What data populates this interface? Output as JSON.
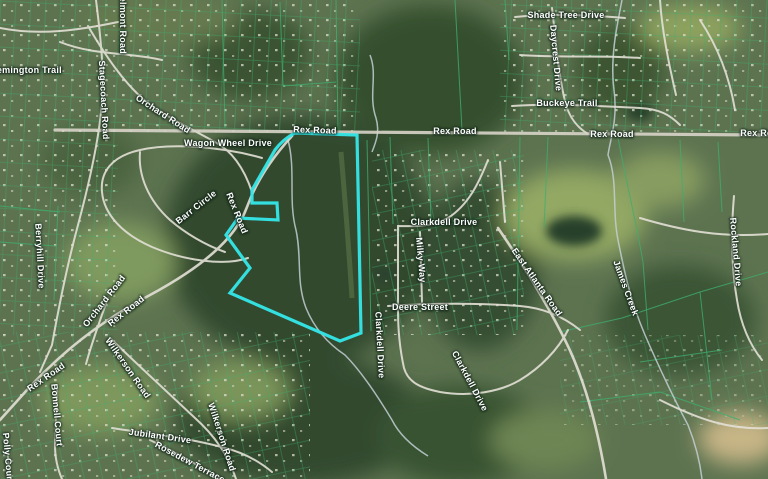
{
  "map": {
    "type": "satellite-parcel-map",
    "description": "Aerial parcel map with one parcel highlighted in cyan near Rex Road",
    "colors": {
      "highlight": "#35e4e6",
      "parcel_lines": "#3fae6e",
      "roads": "#e3e0d6",
      "water": "#c2cfd2",
      "forest_dark": "#31482e",
      "field_light": "#93a863",
      "base": "#5d7350",
      "cleared_tan": "#c7b586"
    },
    "highlight_parcel": {
      "path": "M295,133 L357,135 L361,333 L340,341 L230,293 L250,268 L226,235 L238,218 L278,220 L277,203 L252,203 L252,190 L275,150 Q283,139 295,133 Z"
    },
    "labels": [
      {
        "text": "Remington Trail",
        "x": 26,
        "y": 70,
        "rot": 0
      },
      {
        "text": "Belmont Road",
        "x": 123,
        "y": 22,
        "rot": 90
      },
      {
        "text": "Stagecoach Road",
        "x": 104,
        "y": 100,
        "rot": 87
      },
      {
        "text": "Orchard Road",
        "x": 163,
        "y": 114,
        "rot": 33
      },
      {
        "text": "Wagon Wheel Drive",
        "x": 228,
        "y": 143,
        "rot": 0
      },
      {
        "text": "Rex Road",
        "x": 315,
        "y": 130,
        "rot": 2
      },
      {
        "text": "Rex Road",
        "x": 455,
        "y": 131,
        "rot": 0
      },
      {
        "text": "Rex Road",
        "x": 612,
        "y": 134,
        "rot": 0
      },
      {
        "text": "Rex Road",
        "x": 762,
        "y": 133,
        "rot": 0
      },
      {
        "text": "Shade Tree Drive",
        "x": 566,
        "y": 15,
        "rot": 0
      },
      {
        "text": "Daycrest Drive",
        "x": 556,
        "y": 58,
        "rot": 85
      },
      {
        "text": "Buckeye Trail",
        "x": 567,
        "y": 103,
        "rot": 0
      },
      {
        "text": "Barr Circle",
        "x": 196,
        "y": 207,
        "rot": -38
      },
      {
        "text": "Rex Road",
        "x": 237,
        "y": 213,
        "rot": 68
      },
      {
        "text": "Clarkdell Drive",
        "x": 444,
        "y": 222,
        "rot": 0
      },
      {
        "text": "Milky Way",
        "x": 421,
        "y": 260,
        "rot": 85
      },
      {
        "text": "Deere Street",
        "x": 420,
        "y": 307,
        "rot": 0
      },
      {
        "text": "Clarkdell Drive",
        "x": 380,
        "y": 345,
        "rot": 87
      },
      {
        "text": "Clarkdell Drive",
        "x": 470,
        "y": 381,
        "rot": 62
      },
      {
        "text": "East Atlanta Road",
        "x": 537,
        "y": 282,
        "rot": 55
      },
      {
        "text": "James Creek",
        "x": 626,
        "y": 288,
        "rot": 70
      },
      {
        "text": "Rockland Drive",
        "x": 736,
        "y": 252,
        "rot": 85
      },
      {
        "text": "Berryhill Drive",
        "x": 40,
        "y": 256,
        "rot": 87
      },
      {
        "text": "Orchard Road",
        "x": 104,
        "y": 301,
        "rot": -52
      },
      {
        "text": "Rex Road",
        "x": 126,
        "y": 311,
        "rot": -38
      },
      {
        "text": "Rex Road",
        "x": 46,
        "y": 377,
        "rot": -35
      },
      {
        "text": "Bonnell Court",
        "x": 57,
        "y": 415,
        "rot": 85
      },
      {
        "text": "Polly Court",
        "x": 8,
        "y": 458,
        "rot": 85
      },
      {
        "text": "Wilkerson Road",
        "x": 128,
        "y": 368,
        "rot": 55
      },
      {
        "text": "Jubilant Drive",
        "x": 160,
        "y": 436,
        "rot": 8
      },
      {
        "text": "Rosedew Terrace",
        "x": 190,
        "y": 462,
        "rot": 28
      },
      {
        "text": "Wilkerson Road",
        "x": 222,
        "y": 437,
        "rot": 72
      }
    ]
  }
}
